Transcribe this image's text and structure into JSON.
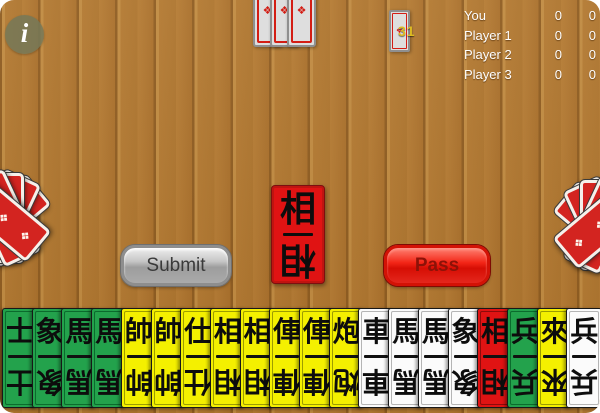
{
  "info": {
    "label": "i"
  },
  "scoreboard": {
    "rows": [
      {
        "name": "You",
        "score1": "0",
        "score2": "0"
      },
      {
        "name": "Player 1",
        "score1": "0",
        "score2": "0"
      },
      {
        "name": "Player 2",
        "score1": "0",
        "score2": "0"
      },
      {
        "name": "Player 3",
        "score1": "0",
        "score2": "0"
      }
    ]
  },
  "deck": {
    "count": "31"
  },
  "opponents": {
    "top": {
      "cards": 3
    },
    "left": {
      "cards": 5
    },
    "right": {
      "cards": 5
    }
  },
  "played_card": {
    "char": "相",
    "color": "red"
  },
  "buttons": {
    "submit": "Submit",
    "pass": "Pass"
  },
  "hand": {
    "cards": [
      {
        "char": "士",
        "color": "green"
      },
      {
        "char": "象",
        "color": "green"
      },
      {
        "char": "馬",
        "color": "green"
      },
      {
        "char": "馬",
        "color": "green"
      },
      {
        "char": "帥",
        "color": "yellow"
      },
      {
        "char": "帥",
        "color": "yellow"
      },
      {
        "char": "仕",
        "color": "yellow"
      },
      {
        "char": "相",
        "color": "yellow"
      },
      {
        "char": "相",
        "color": "yellow"
      },
      {
        "char": "俥",
        "color": "yellow"
      },
      {
        "char": "俥",
        "color": "yellow"
      },
      {
        "char": "炮",
        "color": "yellow"
      },
      {
        "char": "車",
        "color": "white"
      },
      {
        "char": "馬",
        "color": "white"
      },
      {
        "char": "馬",
        "color": "white"
      },
      {
        "char": "象",
        "color": "white"
      },
      {
        "char": "相",
        "color": "red"
      },
      {
        "char": "兵",
        "color": "green"
      },
      {
        "char": "來",
        "color": "yellow"
      },
      {
        "char": "兵",
        "color": "white"
      }
    ]
  },
  "palette": {
    "green": "#23a24c",
    "yellow": "#f4f000",
    "white": "#fbfbfb",
    "red": "#e01313",
    "card_back_red": "#d32420",
    "wood": "#b1772e"
  },
  "icons": {
    "card_back_pattern": "❖"
  }
}
